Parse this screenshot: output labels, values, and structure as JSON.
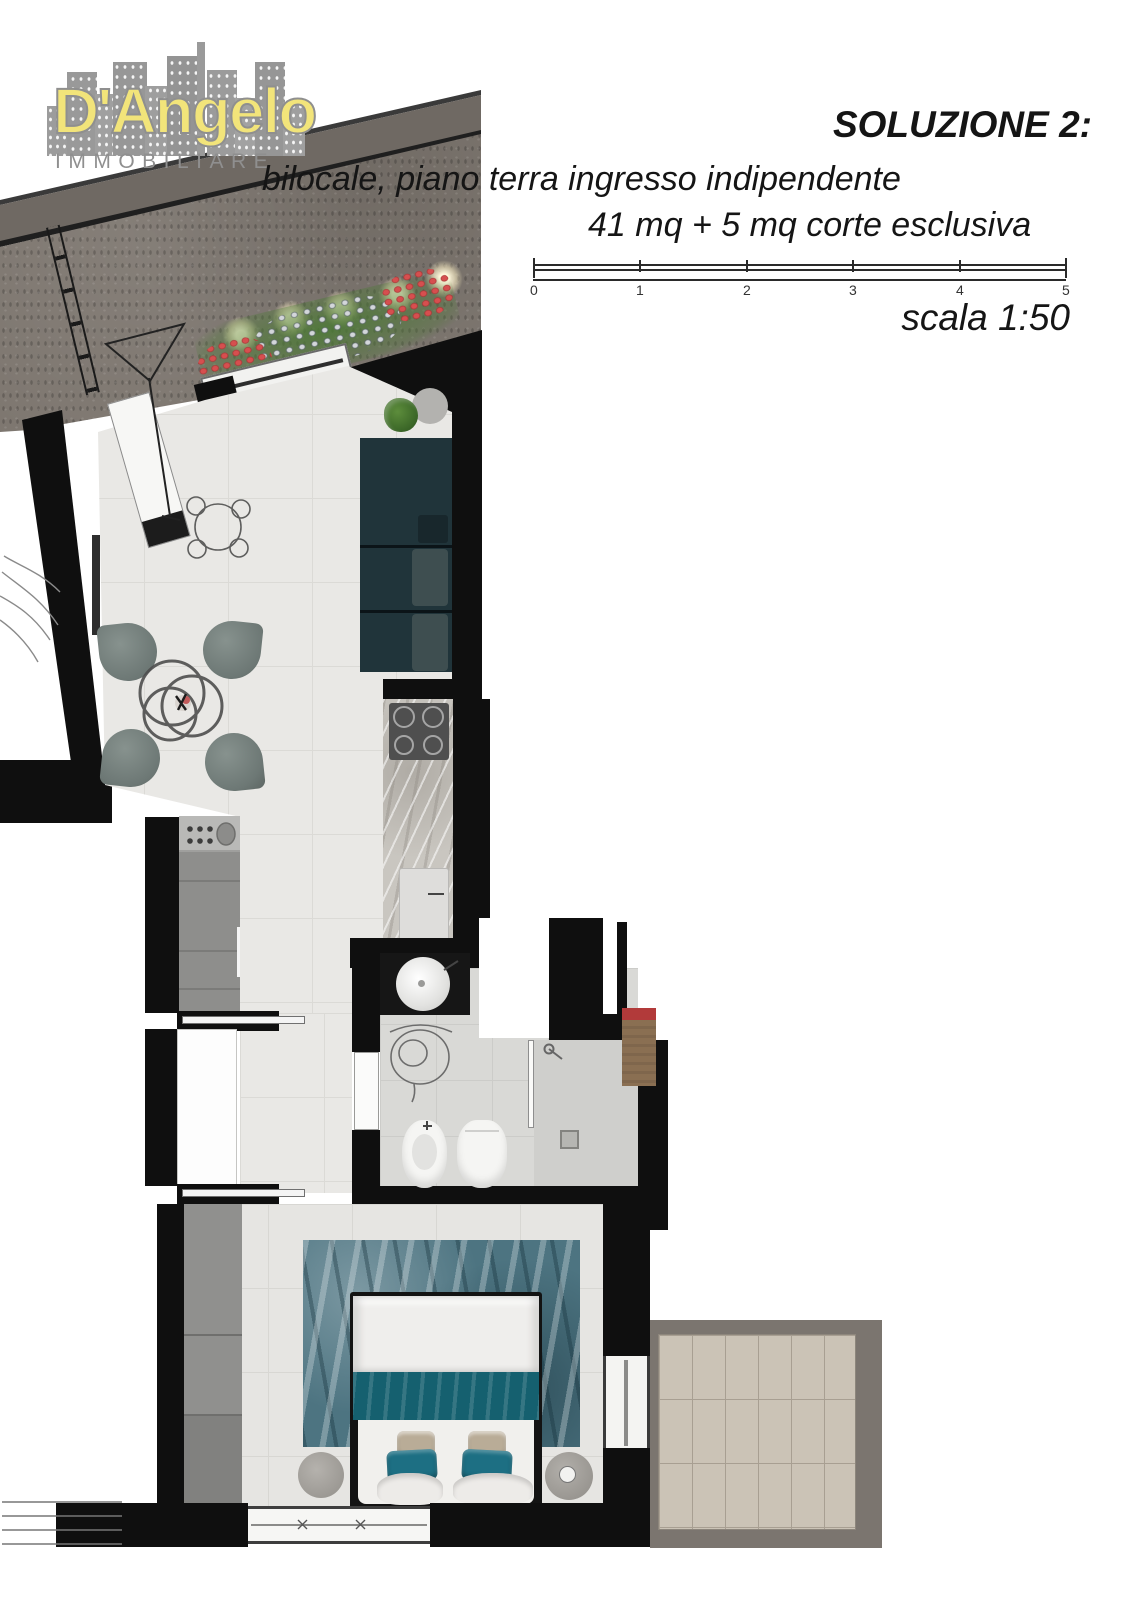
{
  "logo": {
    "name": "D'Angelo",
    "tagline": "IMMOBILIARE"
  },
  "header": {
    "title": "SOLUZIONE 2:",
    "subtitle_line1": "bilocale, piano terra ingresso indipendente",
    "subtitle_line2": "41 mq + 5 mq corte esclusiva",
    "scale_label": "scala 1:50"
  },
  "scalebar": {
    "ticks": [
      "0",
      "1",
      "2",
      "3",
      "4",
      "5"
    ]
  },
  "colors": {
    "wall": "#0f0f0f",
    "courtyard_stone": "#7e7770",
    "floor_tile": "#e9e8e5",
    "bathroom_floor": "#d9d9d6",
    "sofa": "#20343a",
    "dining_chair": "#79837f",
    "rug": "#4d7481",
    "bed_throw": "#15606f",
    "pillow_teal": "#1d6f83",
    "pillow_beige": "#b9ac97",
    "terrace_tile": "#cbc3b6",
    "terrace_wall": "#7b756f",
    "logo_yellow": "#f2e47a",
    "logo_grey": "#8f8f8f",
    "flower_red": "#d64f4f",
    "plant_green": "#4a7a33",
    "cabinet_brown": "#8a6f52"
  }
}
